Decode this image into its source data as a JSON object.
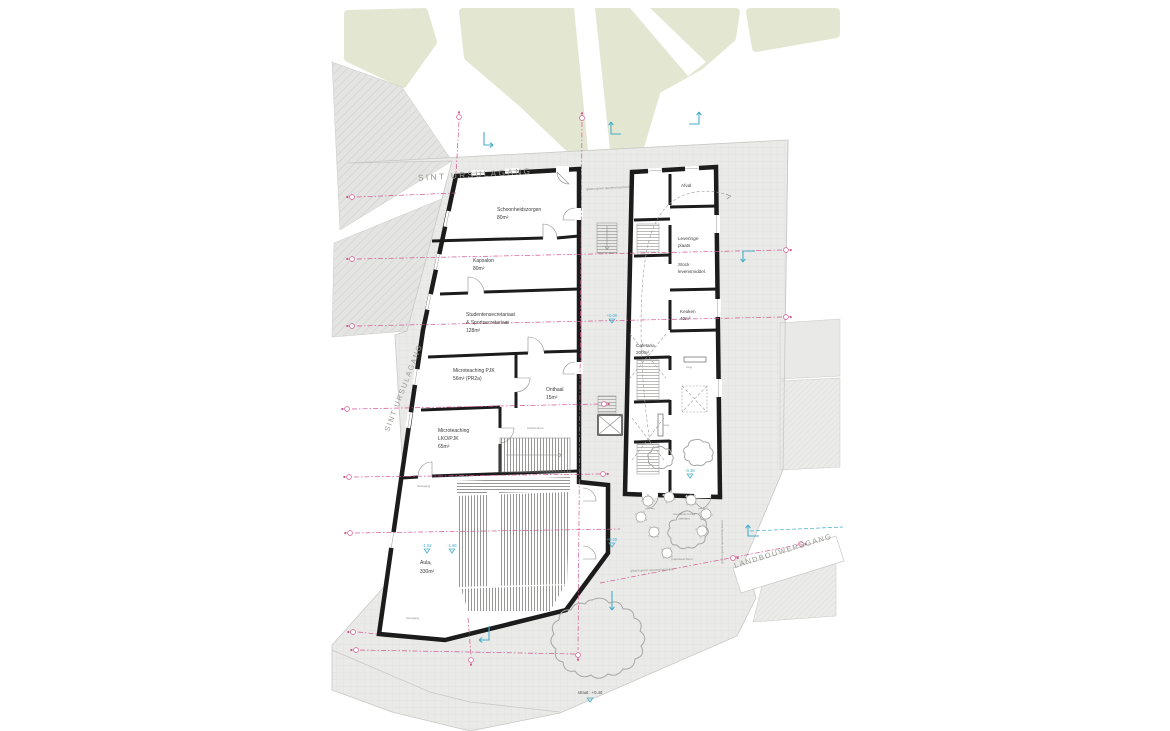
{
  "streets": {
    "sint_ursulagang_top": "SINT URSULAGANG",
    "sint_ursulagang_left": "SINT URSULAGANG",
    "landbouwersgang": "LANDBOUWERSGANG"
  },
  "building_left": {
    "rooms": [
      {
        "name": "Schoonheidszorgen",
        "area": "80m²"
      },
      {
        "name": "Kapsalon",
        "area": "80m²"
      },
      {
        "name": "Studentensecretariaat",
        "name2": "& Sportsecretariaat",
        "area": "128m²"
      },
      {
        "name": "Microteaching PJK",
        "area": "56m² (PR2a)"
      },
      {
        "name": "Onthaal",
        "area": "15m²"
      },
      {
        "name": "Microteaching",
        "name2": "LKO/PJK",
        "area": "65m²"
      },
      {
        "name": "Aula₁",
        "area": "330m²"
      }
    ],
    "small_labels": {
      "wachtruimte": "wachtruimte",
      "doorgang": "doorgang"
    }
  },
  "building_right": {
    "rooms": [
      {
        "name": "Afval"
      },
      {
        "name": "Leverings-",
        "name2": "plaats"
      },
      {
        "name": "Stock",
        "name2": "levensmiddel."
      },
      {
        "name": "Keuken",
        "area": "40m²"
      },
      {
        "name": "Cafetaria",
        "area": "200m²"
      }
    ],
    "small_labels": {
      "toog": "toog"
    }
  },
  "site": {
    "terrace_line1": "overdekte terras",
    "terrace_line2": "cafetaria",
    "projection_screen": "projectiescherm",
    "glass_facade_note": "glazen gevel openend bij brand",
    "street_level_label": "straat : +0.40"
  },
  "levels": {
    "courtyard_upper": "+0.00",
    "courtyard_lower": "+0.00",
    "aula_left": "-1.62",
    "aula_right": "-1.86",
    "wintergarden": "-0.36"
  },
  "colors": {
    "section_line": "#d4568f",
    "level_marker": "#45aecb",
    "green_area": "#e3e7d2",
    "paving": "#eaeae8",
    "wall": "#1c1c1c"
  }
}
